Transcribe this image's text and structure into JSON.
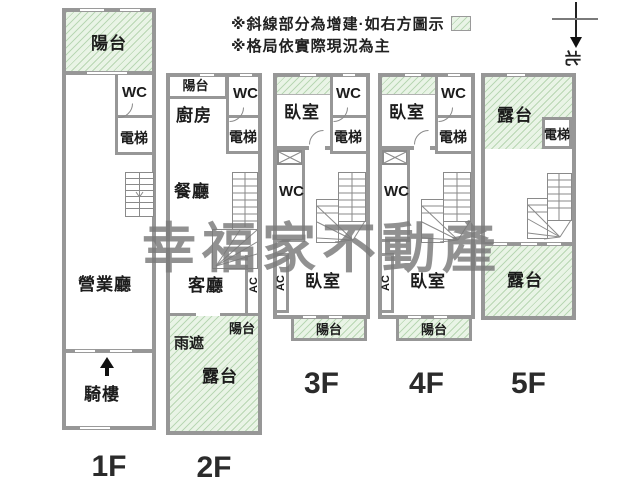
{
  "legend": {
    "line1": "※斜線部分為增建·如右方圖示",
    "line2": "※格局依實際現況為主"
  },
  "compass": {
    "north": "北"
  },
  "watermark": {
    "text": "幸福家不動產"
  },
  "colors": {
    "wall": "#979797",
    "hatch_bg": "#e9f4e6",
    "hatch_line": "#b9d7b4",
    "wm": "#7a7a7a"
  },
  "floors": [
    {
      "label": "1F",
      "rooms": {
        "balcony": "陽台",
        "wc": "WC",
        "elevator": "電梯",
        "business_hall": "營業廳",
        "arcade": "騎樓"
      }
    },
    {
      "label": "2F",
      "rooms": {
        "balcony": "陽台",
        "wc": "WC",
        "elevator": "電梯",
        "kitchen": "廚房",
        "dining": "餐廳",
        "living": "客廳",
        "ac": "AC",
        "balcony_rear": "陽台",
        "rain_shade": "雨遮",
        "terrace": "露台"
      }
    },
    {
      "label": "3F",
      "rooms": {
        "bedroom_front": "臥室",
        "wc": "WC",
        "elevator": "電梯",
        "wc_mid": "WC",
        "ac": "AC",
        "bedroom_rear": "臥室",
        "balcony": "陽台"
      }
    },
    {
      "label": "4F",
      "rooms": {
        "bedroom_front": "臥室",
        "wc": "WC",
        "elevator": "電梯",
        "wc_mid": "WC",
        "ac": "AC",
        "bedroom_rear": "臥室",
        "balcony": "陽台"
      }
    },
    {
      "label": "5F",
      "rooms": {
        "terrace_front": "露台",
        "elevator": "電梯",
        "terrace_rear": "露台"
      }
    }
  ]
}
